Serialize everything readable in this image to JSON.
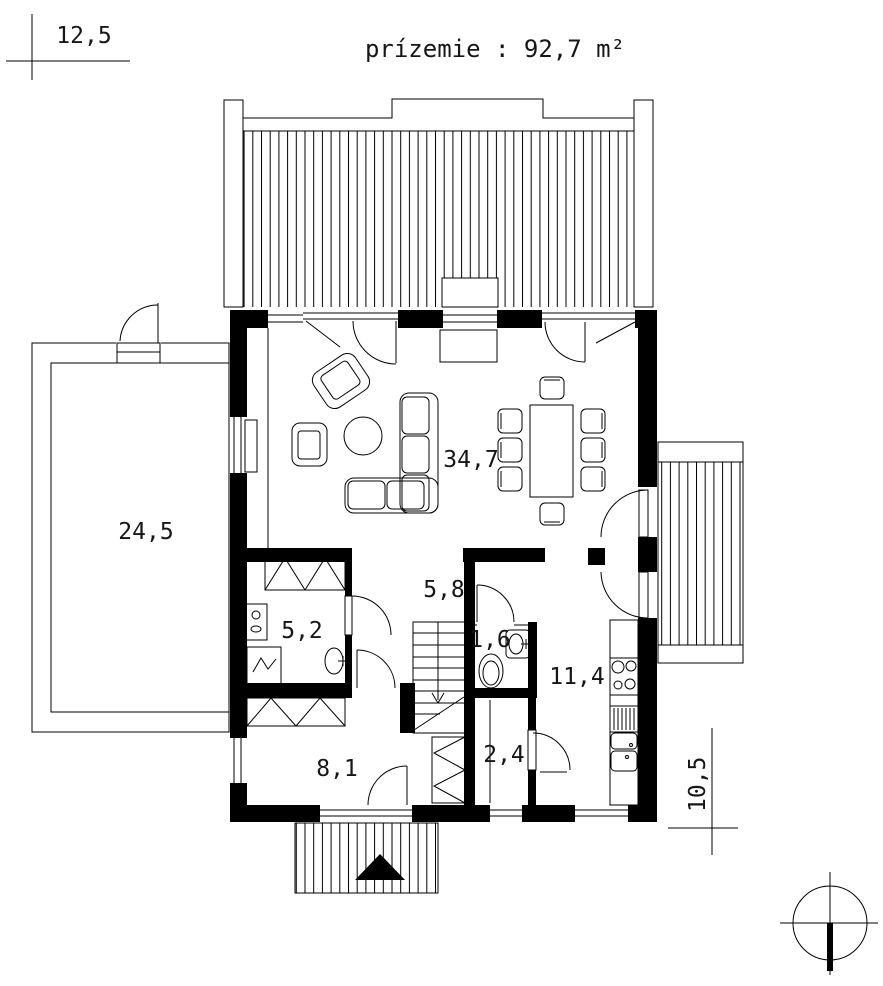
{
  "title": "prízemie : 92,7 m²",
  "dimensions": {
    "top_width": "12,5",
    "side_depth": "10,5"
  },
  "rooms": {
    "garage_area": "24,5",
    "living_area": "34,7",
    "hall_area": "5,8",
    "bathroom_area": "5,2",
    "wc_area": "1,6",
    "kitchen_area": "11,4",
    "bedroom_area": "8,1",
    "pantry_area": "2,4"
  },
  "colors": {
    "ink": "#000000",
    "paper": "#ffffff"
  }
}
